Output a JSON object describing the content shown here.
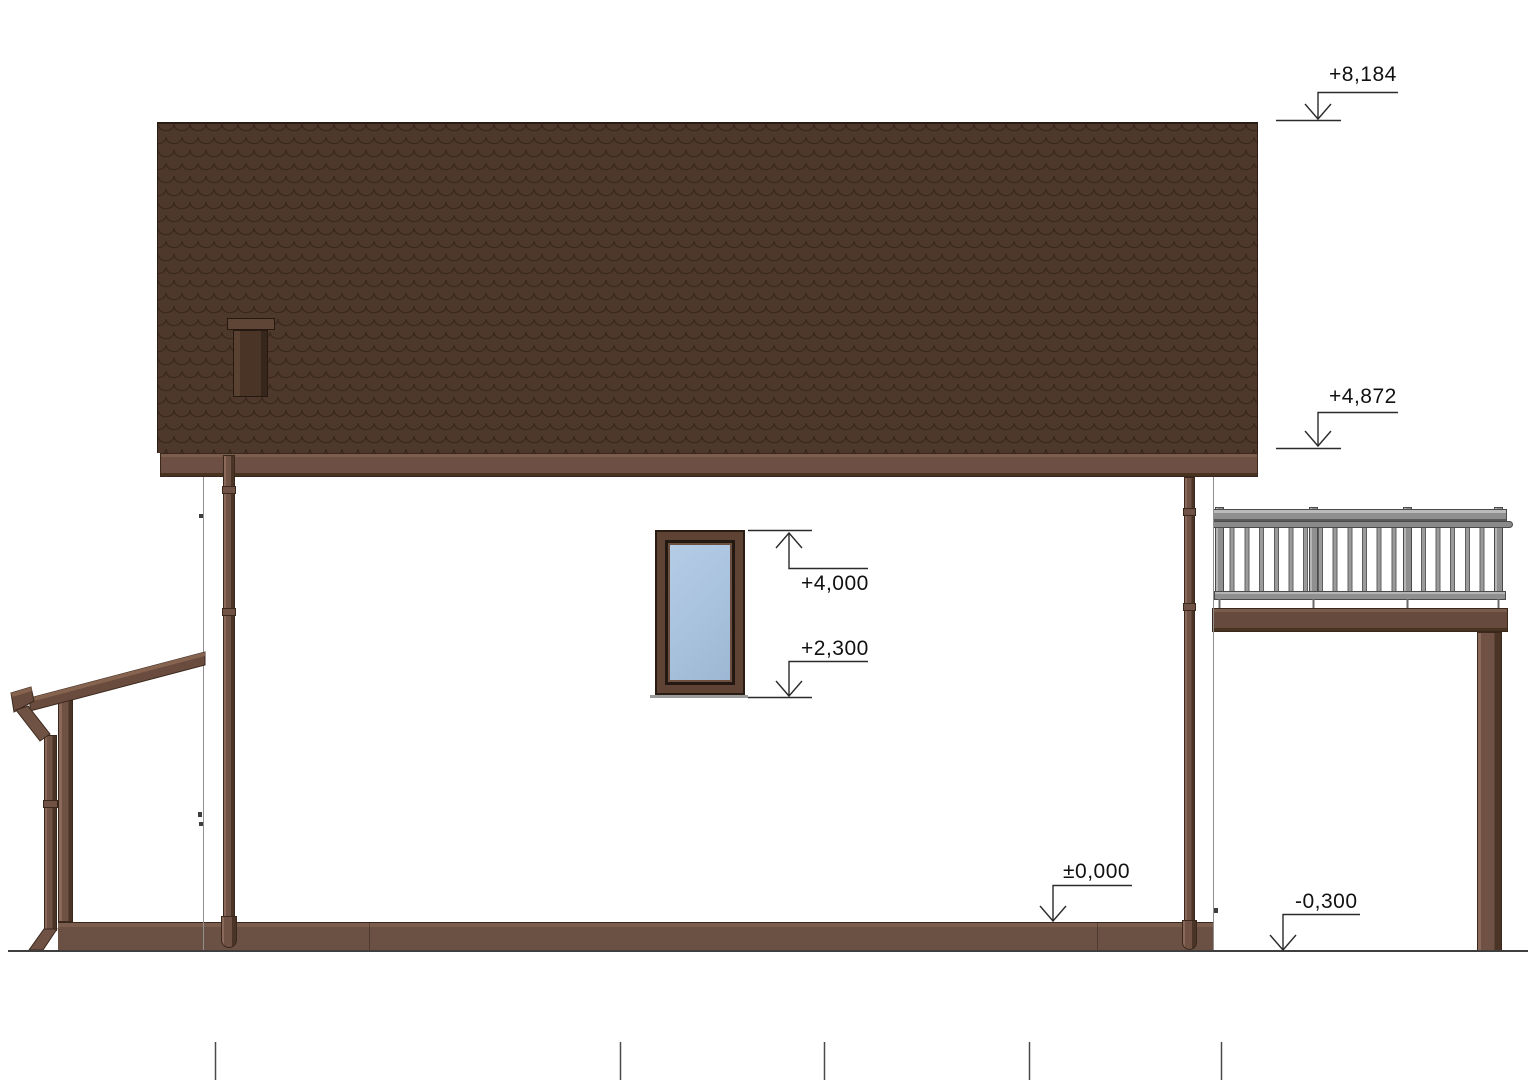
{
  "drawing": {
    "type": "architectural-elevation",
    "subject": "single-family house, side elevation with porch canopy and balcony",
    "background": "#ffffff"
  },
  "elevation_markers": {
    "roof_ridge": {
      "label": "+8,184",
      "arrow_direction": "down",
      "points_to": "top of roof"
    },
    "roof_eaves": {
      "label": "+4,872",
      "arrow_direction": "down",
      "points_to": "eaves / bottom edge of roof"
    },
    "window_top": {
      "label": "+4,000",
      "arrow_direction": "up",
      "points_to": "window head"
    },
    "window_bottom": {
      "label": "+2,300",
      "arrow_direction": "down",
      "points_to": "window sill"
    },
    "floor_level": {
      "label": "±0,000",
      "arrow_direction": "down",
      "points_to": "top of plinth / floor level"
    },
    "ground_level": {
      "label": "-0,300",
      "arrow_direction": "down",
      "points_to": "ground line"
    }
  },
  "colors": {
    "roof_tile": "#4e382b",
    "roof_tile_line": "#33231a",
    "wood_trim": "#6d5043",
    "wood_pipe": "#6f5244",
    "plinth": "#6b5044",
    "window_frame": "#5e4335",
    "window_glass": "#adc6e1",
    "railing_gray": "#8f8f8f",
    "drawing_line": "#2b2b2b"
  },
  "elements": {
    "roof": "scalloped tile roof slope",
    "chimney": "roof vent stack with cap",
    "fascia": "eaves fascia board",
    "window": "first-floor window",
    "balcony": "balcony deck with metal railing and support post",
    "porch": "lean-to porch canopy with post, gutter and downpipe",
    "downpipes": 3,
    "plinth": "foundation plinth band",
    "ground_axis_ticks": 5
  }
}
